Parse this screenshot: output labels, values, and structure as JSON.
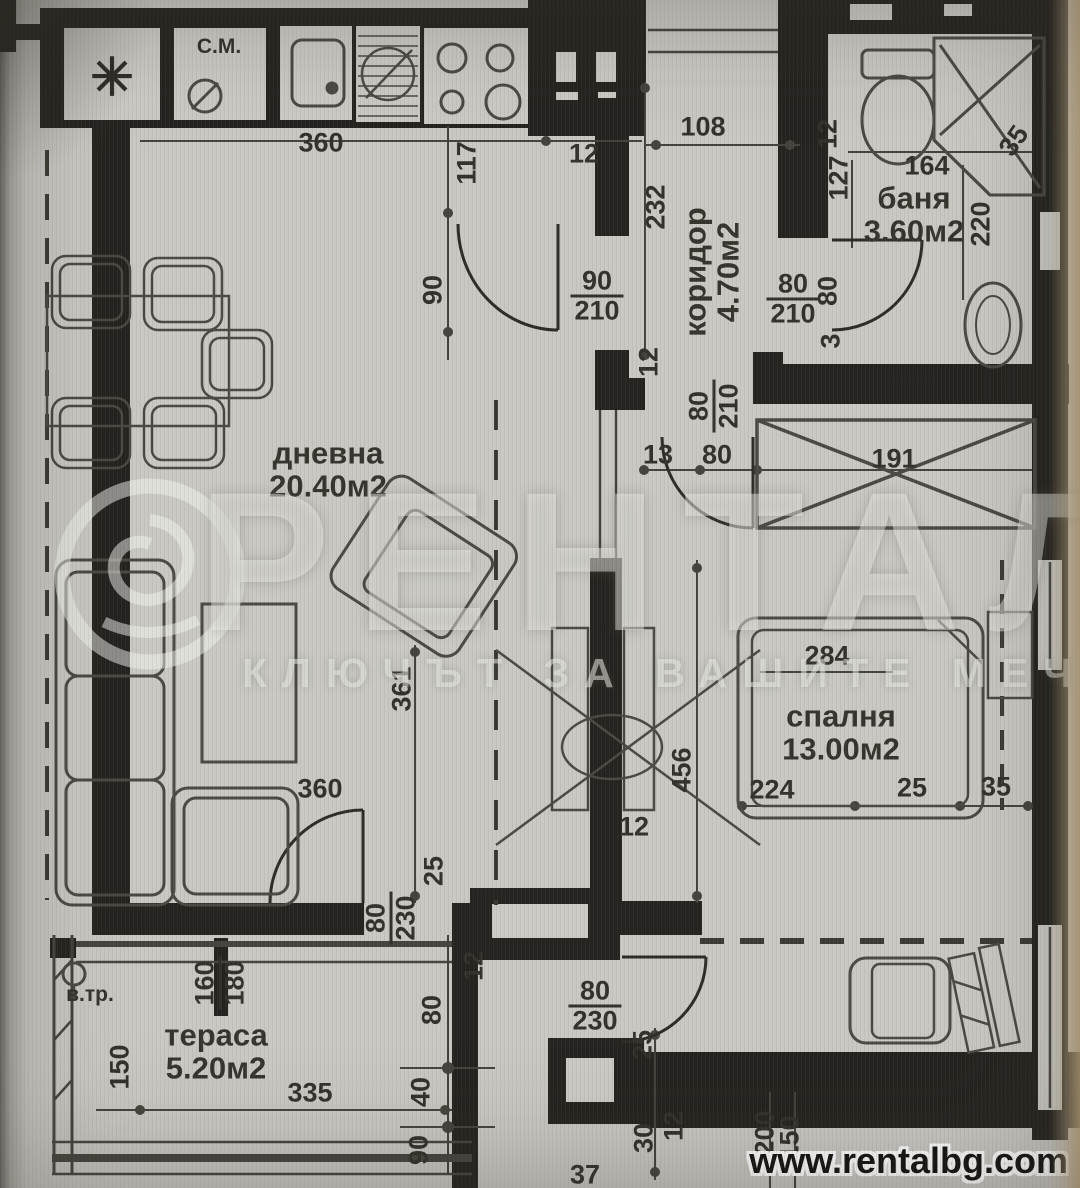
{
  "watermark": {
    "title": "РЕНТАЛ",
    "subtitle": "КЛЮЧЪТ ЗА ВАШИТЕ МЕЧТИ"
  },
  "footer": {
    "website": "www.rentalbg.com"
  },
  "rooms": [
    {
      "key": "living",
      "name": "дневна",
      "area": "20.40м2",
      "x": 328,
      "y": 470
    },
    {
      "key": "bedroom",
      "name": "спалня",
      "area": "13.00м2",
      "x": 841,
      "y": 733
    },
    {
      "key": "bathroom",
      "name": "баня",
      "area": "3.60м2",
      "x": 914,
      "y": 215
    },
    {
      "key": "corridor",
      "name": "коридор",
      "area": "4.70м2",
      "x": 712,
      "y": 272,
      "r": -90
    },
    {
      "key": "terrace",
      "name": "тераса",
      "area": "5.20м2",
      "x": 216,
      "y": 1052
    }
  ],
  "small_labels": [
    {
      "key": "washing-machine",
      "t": "С.М.",
      "x": 219,
      "y": 47
    },
    {
      "key": "vtr",
      "t": "в.тр.",
      "x": 90,
      "y": 995
    }
  ],
  "symbols": [
    {
      "key": "fridge-star",
      "t": "✳",
      "x": 112,
      "y": 78
    }
  ],
  "dims": [
    {
      "t": "360",
      "x": 321,
      "y": 143
    },
    {
      "t": "12",
      "x": 584,
      "y": 154
    },
    {
      "t": "117",
      "x": 467,
      "y": 163,
      "r": -90
    },
    {
      "t": "108",
      "x": 703,
      "y": 127
    },
    {
      "t": "232",
      "x": 656,
      "y": 207,
      "r": -90
    },
    {
      "t": "90",
      "x": 433,
      "y": 290,
      "r": -90
    },
    {
      "t": "90",
      "b": "210",
      "x": 597,
      "y": 296
    },
    {
      "t": "80",
      "b": "210",
      "x": 793,
      "y": 299
    },
    {
      "t": "80",
      "x": 828,
      "y": 291,
      "r": -90
    },
    {
      "t": "3",
      "x": 831,
      "y": 341,
      "r": -90
    },
    {
      "t": "12",
      "x": 828,
      "y": 134,
      "r": -90
    },
    {
      "t": "127",
      "x": 839,
      "y": 178,
      "r": -90
    },
    {
      "t": "164",
      "x": 927,
      "y": 166
    },
    {
      "t": "220",
      "x": 981,
      "y": 224,
      "r": -90
    },
    {
      "t": "35",
      "x": 1014,
      "y": 141,
      "r": -55
    },
    {
      "t": "12",
      "x": 649,
      "y": 362,
      "r": -90
    },
    {
      "t": "80",
      "b": "210",
      "x": 714,
      "y": 406,
      "r": -90
    },
    {
      "t": "13",
      "x": 658,
      "y": 455
    },
    {
      "t": "80",
      "x": 717,
      "y": 455
    },
    {
      "t": "191",
      "x": 894,
      "y": 459
    },
    {
      "t": "284",
      "x": 827,
      "y": 656
    },
    {
      "t": "361",
      "x": 402,
      "y": 689,
      "r": -90
    },
    {
      "t": "456",
      "x": 682,
      "y": 770,
      "r": -90
    },
    {
      "t": "224",
      "x": 772,
      "y": 790
    },
    {
      "t": "25",
      "x": 912,
      "y": 788
    },
    {
      "t": "35",
      "x": 996,
      "y": 787
    },
    {
      "t": "360",
      "x": 320,
      "y": 789
    },
    {
      "t": "25",
      "x": 434,
      "y": 871,
      "r": -90
    },
    {
      "t": "80",
      "b": "230",
      "x": 391,
      "y": 918,
      "r": -90
    },
    {
      "t": "12",
      "x": 474,
      "y": 966,
      "r": -90
    },
    {
      "t": "12",
      "x": 634,
      "y": 827
    },
    {
      "t": "80",
      "x": 432,
      "y": 1010,
      "r": -90
    },
    {
      "t": "40",
      "x": 421,
      "y": 1092,
      "r": -90
    },
    {
      "t": "90",
      "x": 419,
      "y": 1150,
      "r": -90
    },
    {
      "t": "160",
      "b": "180",
      "x": 220,
      "y": 983,
      "r": -90
    },
    {
      "t": "150",
      "x": 120,
      "y": 1067,
      "r": -90
    },
    {
      "t": "335",
      "x": 310,
      "y": 1093
    },
    {
      "t": "80",
      "b": "230",
      "x": 595,
      "y": 1006
    },
    {
      "t": "25",
      "x": 643,
      "y": 1045,
      "r": -90
    },
    {
      "t": "30",
      "x": 644,
      "y": 1138,
      "r": -90
    },
    {
      "t": "12",
      "x": 674,
      "y": 1126,
      "r": -90
    },
    {
      "t": "200",
      "x": 765,
      "y": 1133,
      "r": -90
    },
    {
      "t": "150",
      "x": 790,
      "y": 1138,
      "r": -90
    },
    {
      "t": "37",
      "x": 585,
      "y": 1175
    }
  ]
}
